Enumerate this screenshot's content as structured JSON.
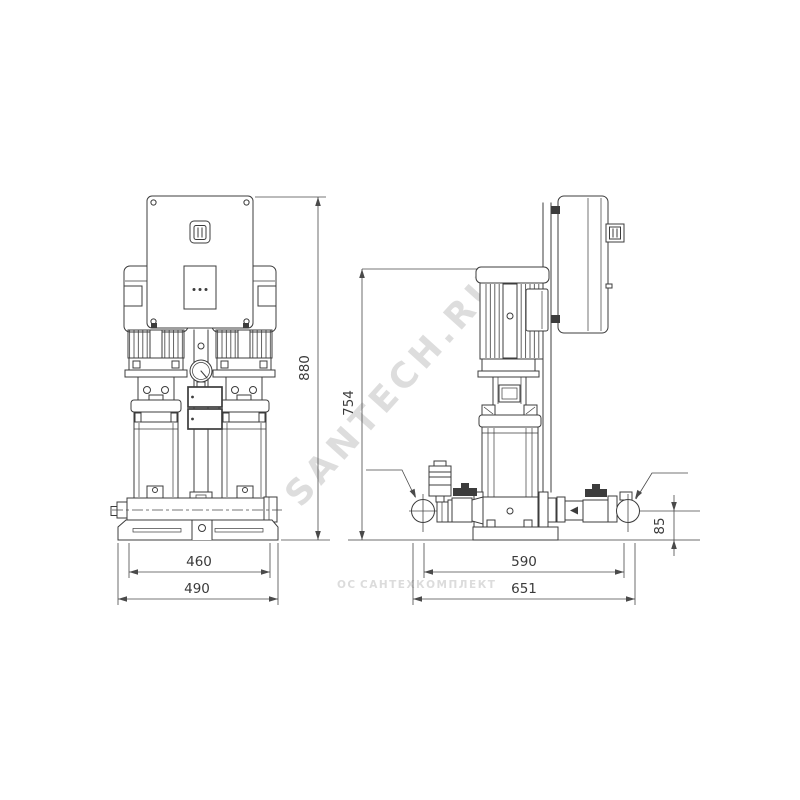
{
  "colors": {
    "page": "#ffffff",
    "line": "#3c3c3c",
    "dimension": "#4a4a4a",
    "text": "#3a3a3a",
    "watermark_diagonal": "#b0b0b0",
    "watermark_small": "#dcdcdc"
  },
  "front_view": {
    "dim_height_total": "880",
    "dim_base_inner_width": "460",
    "dim_base_outer_width": "490"
  },
  "side_view": {
    "dim_height_to_motor_top": "754",
    "dim_port_span": "590",
    "dim_overall_length": "651",
    "dim_pipe_centerline_height": "85",
    "flow_direction": "left"
  },
  "watermarks": {
    "diagonal": "SANTECH.RU",
    "footer_logo": "ОС",
    "footer": "САНТЕХКОМПЛЕКТ"
  }
}
